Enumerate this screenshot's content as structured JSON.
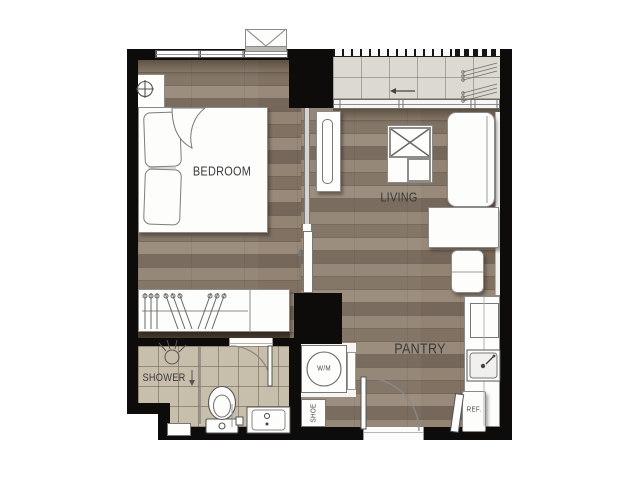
{
  "labels": {
    "bedroom": "BEDROOM",
    "living": "LIVING",
    "pantry": "PANTRY",
    "shower": "SHOWER",
    "washing_machine": "W/M",
    "shoe_cabinet": "SHOE",
    "refrigerator": "REF."
  },
  "icons": {
    "bed": "rect-with-pillows-and-blanket-fold",
    "wardrobe": "rect-with-hanger-glyphs",
    "bedside_lamp": "circle-crosshair",
    "bedroom_window": "triple-pane-band",
    "ac_ledge": "box-with-v-diagonals",
    "balcony_railing": "ticked-band",
    "ac_condenser": "diagonal-louver-lines",
    "sliding_door": "rail-band-with-arrow",
    "tv_console": "rect-with-rounded-slab",
    "coffee_table": "square-with-x-and-seat",
    "sofa": "rounded-rect-with-back-line",
    "desk": "rect",
    "chair": "rounded-rect-with-split-line",
    "kitchen_counter": "long-rect-with-center-line",
    "cooktop": "square",
    "kitchen_sink": "basin-with-faucet-lever",
    "washing_machine": "circle-in-square",
    "toilet": "ellipse-bowl-with-tank",
    "vanity_sink": "basin-with-tap-dots",
    "shower_head": "circle-with-spray-rays",
    "glass_partition": "thin-line",
    "door_swing": "quarter-arc-with-leaf"
  },
  "colors": {
    "background": "#ffffff",
    "wall": "#0d0c0a",
    "wood_floor": "#8b7b6a",
    "wood_shadow": "#453a2d",
    "bathroom_tile": "#c8beac",
    "balcony_tile": "#dcd9d1",
    "furniture_fill": "#fdfdfc",
    "furniture_outline": "#8a8a8a",
    "label_text": "#3a3a3a"
  }
}
